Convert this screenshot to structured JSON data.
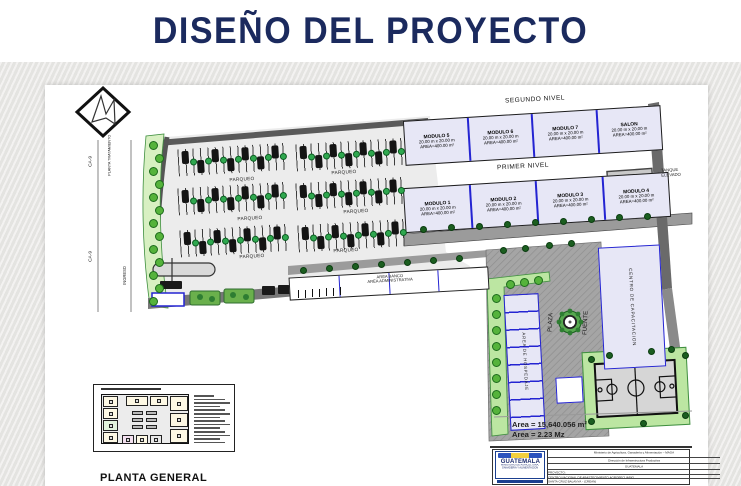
{
  "slide": {
    "title": "DISEÑO DEL PROYECTO"
  },
  "plan": {
    "roads": {
      "ca9_top": "CA-9",
      "ca9_bottom": "CA-9",
      "planta_tratamiento": "PLANTA TRATAMIENTO",
      "ingreso": "INGRESO"
    },
    "segundo": {
      "heading": "SEGUNDO NIVEL",
      "modules": [
        {
          "name": "MODULO 5",
          "dims": "20.00 m x 20.00 m",
          "area": "AREA=400.00 m²"
        },
        {
          "name": "MODULO 6",
          "dims": "20.00 m x 20.00 m",
          "area": "AREA=400.00 m²"
        },
        {
          "name": "MODULO 7",
          "dims": "20.00 m x 20.00 m",
          "area": "AREA=400.00 m²"
        },
        {
          "name": "SALON",
          "dims": "20.00 m x 20.00 m",
          "area": "AREA=400.00 m²"
        }
      ]
    },
    "primer": {
      "heading": "PRIMER NIVEL",
      "modules": [
        {
          "name": "MODULO 1",
          "dims": "20.00 m x 20.00 m",
          "area": "AREA=400.00 m²"
        },
        {
          "name": "MODULO 2",
          "dims": "20.00 m x 20.00 m",
          "area": "AREA=400.00 m²"
        },
        {
          "name": "MODULO 3",
          "dims": "20.00 m x 20.00 m",
          "area": "AREA=400.00 m²"
        },
        {
          "name": "MODULO 4",
          "dims": "20.00 m x 20.00 m",
          "area": "AREA=400.00 m²"
        }
      ]
    },
    "tanque": "TANQUE ELEVADO",
    "parqueo": "PARQUEO",
    "banco": {
      "line1": "AREA BANCO",
      "line2": "AREA ADMINISTRATIVA"
    },
    "centro": "CENTRO DE CAPACITACION",
    "hospedaje": "AREA DE HOSPEDAJE",
    "plaza": "PLAZA",
    "fuente": "FUENTE",
    "areas": {
      "m2": "Area = 15,640.056 m²",
      "mz": "Area = 2.23 Mz"
    },
    "planta_general": "PLANTA GENERAL"
  },
  "titleblock": {
    "ministry": "Ministerio de Agricultura, Ganadería y Alimentación – MAGA",
    "direccion": "Dirección de Infraestructura Productiva",
    "country": "GUATEMALA",
    "proyecto_label": "PROYECTO:",
    "proyecto_name": "CENTRO NACIONAL DE ABASTECIMIENTO AGROPECUARIO",
    "proyecto_loc": "SANTA CRUZ BALANYA - (CREAN)",
    "logo_word": "GUATEMALA",
    "logo_sub": "MINISTERIO DE AGRICULTURA, GANADERIA Y ALIMENTACION"
  },
  "colors": {
    "title_navy": "#1b2a5e",
    "module_fill": "#e7e7f6",
    "divider_blue": "#2424d2",
    "green_light": "#55b33b",
    "green_dark": "#1b5e20",
    "plaza_gray": "#a3a3a3"
  }
}
